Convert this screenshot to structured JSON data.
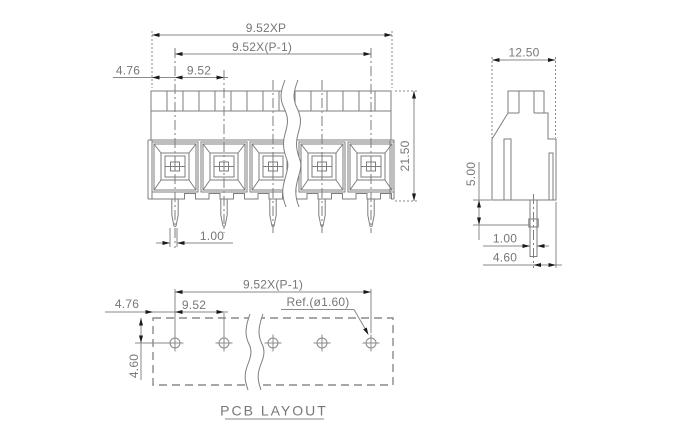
{
  "drawing": {
    "type": "terminal-block-engineering-drawing",
    "caption": "PCB LAYOUT",
    "colors": {
      "line": "#7e7e7e",
      "text": "#777777",
      "arrow": "#1a1a1a",
      "background": "#ffffff"
    },
    "front_view": {
      "pole_count": 5,
      "dim_total_width": "9.52XP",
      "dim_pitch_span": "9.52X(P-1)",
      "dim_end_margin": "4.76",
      "dim_pitch": "9.52",
      "dim_height": "21.50",
      "dim_pin_width": "1.00"
    },
    "side_view": {
      "dim_width": "12.50",
      "dim_pin_length": "5.00",
      "dim_pin_width": "1.00",
      "dim_pin_to_front": "4.60"
    },
    "pcb_layout": {
      "hole_count": 5,
      "dim_pitch_span": "9.52X(P-1)",
      "dim_end_margin": "4.76",
      "dim_pitch": "9.52",
      "dim_hole_ref": "Ref.(ø1.60)",
      "dim_row_offset": "4.60"
    }
  }
}
